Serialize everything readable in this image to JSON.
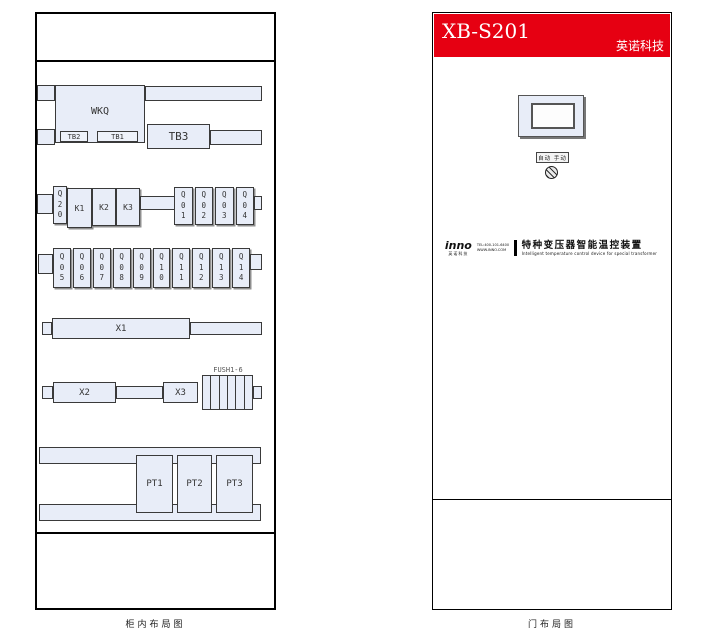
{
  "page": {
    "left_caption": "柜内布局图",
    "right_caption": "门布局图"
  },
  "cabinet": {
    "wkq_label": "WKQ",
    "tb2_label": "TB2",
    "tb1_label": "TB1",
    "tb3_label": "TB3",
    "q20_label": "Q20",
    "k_labels": [
      "K1",
      "K2",
      "K3"
    ],
    "q_row1_labels": [
      "Q01",
      "Q02",
      "Q03",
      "Q04"
    ],
    "q_row2_labels": [
      "Q05",
      "Q06",
      "Q07",
      "Q08",
      "Q09",
      "Q10",
      "Q11",
      "Q12",
      "Q13",
      "Q14"
    ],
    "x1_label": "X1",
    "x2_label": "X2",
    "x3_label": "X3",
    "fuse_label": "FUSH1-6",
    "pt_labels": [
      "PT1",
      "PT2",
      "PT3"
    ]
  },
  "door": {
    "model": "XB-S201",
    "brand": "英诺科技",
    "header_color": "#e60012",
    "mode_label": "自动 手动",
    "logo_text": "inno",
    "logo_sub": "英诺科技",
    "logo_tel": "TEL:400-101-6400",
    "logo_web": "WWW.INNO.COM",
    "product_cn": "特种变压器智能温控装置",
    "product_en": "Intelligent temperature control device for special transformer"
  },
  "colors": {
    "block_fill": "#e8edf8",
    "header_red": "#e60012"
  }
}
